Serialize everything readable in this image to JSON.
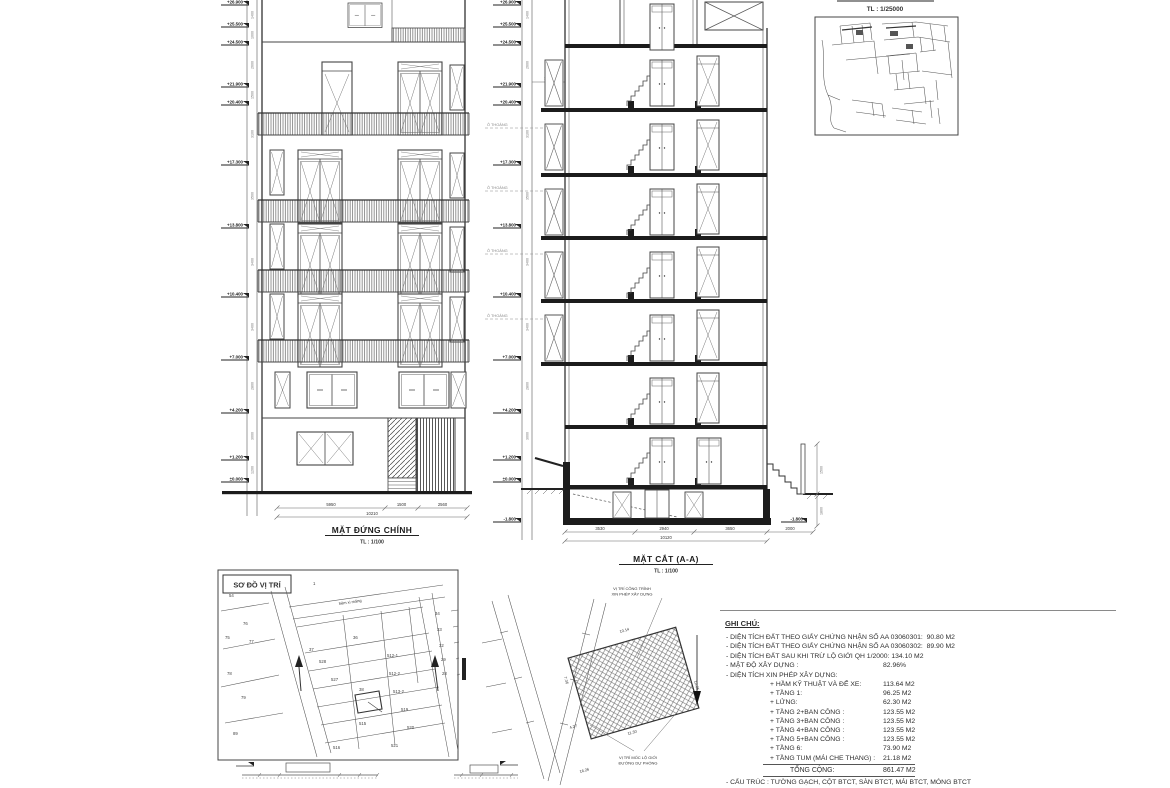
{
  "sheet": {
    "paper": "#ffffff",
    "ink": "#3a3a3a"
  },
  "elevation": {
    "title": "MẶT ĐỨNG CHÍNH",
    "scale": "TL : 1/100",
    "levels": [
      "+26.900",
      "+25.500",
      "+24.500",
      "+21.900",
      "+20.400",
      "+17.300",
      "+13.800",
      "+10.400",
      "+7.000",
      "+4.200",
      "+1.200",
      "±0.000"
    ],
    "dims": [
      "5950",
      "1500",
      "2560"
    ],
    "total_dim": "10210"
  },
  "section": {
    "title": "MẶT CẮT (A-A)",
    "scale": "TL : 1/100",
    "o_thoang": "Ô THOÁNG",
    "levels": [
      "+26.900",
      "+25.500",
      "+24.500",
      "+21.900",
      "+20.400",
      "+17.300",
      "+13.800",
      "+10.400",
      "+7.000",
      "+4.200",
      "+1.200",
      "±0.000"
    ],
    "basement_level": "-1.800",
    "dims": [
      "3530",
      "2940",
      "3650"
    ],
    "total_dim": "10120",
    "right_dim": "2000",
    "bracket_dim": "3500",
    "stair_dims": [
      "1500",
      "1800"
    ]
  },
  "ruler_dims": [
    "1400",
    "1000",
    "2600",
    "1500",
    "3100",
    "3500",
    "3400",
    "3400",
    "2800",
    "3000",
    "1200"
  ],
  "map": {
    "scale": "TL : 1/25000"
  },
  "site": {
    "title": "SƠ ĐỒ VỊ TRÍ",
    "street_label": "hẻm xi măng",
    "parcels": [
      "1",
      "54",
      "76",
      "75",
      "77",
      "78",
      "79",
      "89",
      "37",
      "36",
      "38",
      "528",
      "527",
      "512-1",
      "512-2",
      "513-2",
      "519",
      "515",
      "520",
      "521",
      "516",
      "34",
      "33",
      "32",
      "29",
      "28"
    ]
  },
  "plot": {
    "label_top_1": "VỊ TRÍ CÔNG TRÌNH",
    "label_top_2": "XIN PHÉP XÂY DỰNG",
    "label_bottom_1": "VỊ TRÍ MỐC LỘ GIỚI",
    "label_bottom_2": "ĐƯỜNG DỰ PHÓNG",
    "dims": [
      "10.14",
      "11.30",
      "12.05",
      "4.27",
      "7.36",
      "16.26"
    ]
  },
  "notes": {
    "heading": "GHI CHÚ:",
    "line1": "- DIỆN TÍCH ĐẤT THEO GIẤY CHỨNG NHẬN SỐ AA 03060301:  90.80 M2",
    "line2": "- DIỆN TÍCH ĐẤT THEO GIẤY CHỨNG NHẬN SỐ AA 03060302:  89.90 M2",
    "line3": "- DIỆN TÍCH ĐẤT SAU KHI TRỪ LỘ GIỚI QH 1/2000: 134.10 M2",
    "line4_label": "- MẬT ĐỘ XÂY DỰNG :",
    "line4_value": "82.96%",
    "line5": "- DIỆN TÍCH XIN PHÉP XÂY DỰNG:",
    "areas": [
      {
        "label": "+ HẦM KỸ THUẬT VÀ ĐỂ XE:",
        "value": "113.64 M2"
      },
      {
        "label": "+ TẦNG 1:",
        "value": "96.25 M2"
      },
      {
        "label": "+ LỬNG:",
        "value": "62.30 M2"
      },
      {
        "label": "+ TẦNG 2+BAN CÔNG :",
        "value": "123.55 M2"
      },
      {
        "label": "+ TẦNG 3+BAN CÔNG :",
        "value": "123.55 M2"
      },
      {
        "label": "+ TẦNG 4+BAN CÔNG :",
        "value": "123.55 M2"
      },
      {
        "label": "+ TẦNG 5+BAN CÔNG :",
        "value": "123.55 M2"
      },
      {
        "label": "+ TẦNG 6:",
        "value": "73.90 M2"
      },
      {
        "label": "+ TẦNG TUM (MÁI CHE THANG) :",
        "value": "21.18 M2"
      }
    ],
    "total_label": "TỔNG CỘNG:",
    "total_value": "861.47 M2",
    "structure_line": "- CẤU TRÚC : TƯỜNG GẠCH, CỘT BTCT, SÀN BTCT, MÁI BTCT, MÓNG BTCT"
  }
}
